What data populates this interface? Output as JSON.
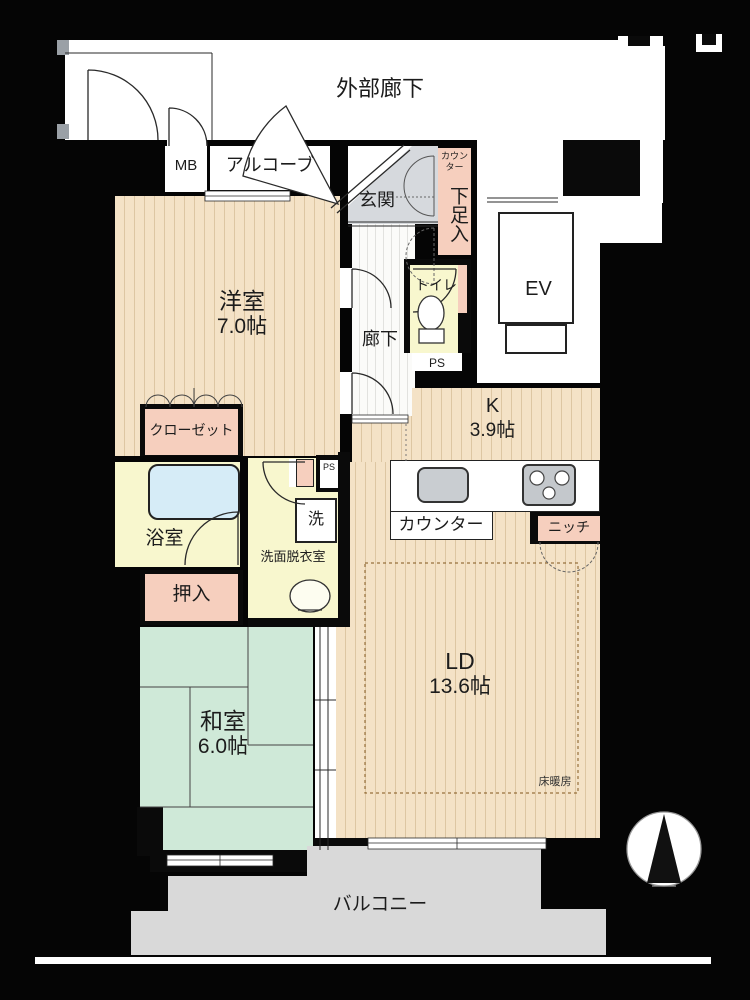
{
  "fp": {
    "common": {
      "exterior_corridor": "外部廊下",
      "alcove": "アルコーブ",
      "meter_box": "MB",
      "elevator": "EV",
      "entrance": "玄関",
      "hallway": "廊下",
      "shoe_counter": "カウンター",
      "shoe_cabinet": "下足入"
    },
    "rooms": {
      "western": {
        "name": "洋室",
        "size": "7.0帖"
      },
      "kitchen": {
        "name": "K",
        "size": "3.9帖"
      },
      "living_dining": {
        "name": "LD",
        "size": "13.6帖"
      },
      "japanese": {
        "name": "和室",
        "size": "6.0帖"
      }
    },
    "sanitary": {
      "toilet": "トイレ",
      "bathroom": "浴室",
      "washroom": "洗面脱衣室",
      "washing_machine": "洗",
      "pipe_space_hall": "PS",
      "pipe_space_wash": "PS"
    },
    "storage": {
      "closet": "クローゼット",
      "oshiire": "押入",
      "niche": "ニッチ"
    },
    "kitchen_fixtures": {
      "counter": "カウンター"
    },
    "features": {
      "floor_heating": "床暖房"
    },
    "outdoor": {
      "balcony": "バルコニー"
    },
    "icons": {
      "compass": "north-arrow",
      "toilet": "toilet-bowl",
      "sink": "wash-basin",
      "stove": "three-burner-stove",
      "bathtub": "bathtub"
    },
    "palette": {
      "wall": "#000000",
      "flooring": "#f4e2c6",
      "flooring_stripe": "#ddc6a2",
      "tatami": "#cfe9d8",
      "wet_room": "#f8f7ce",
      "storage_pink": "#f6cfbe",
      "bathtub": "#d6ecf7",
      "entrance_gray": "#d6d9dd",
      "balcony_gray": "#d9d9d9"
    }
  }
}
